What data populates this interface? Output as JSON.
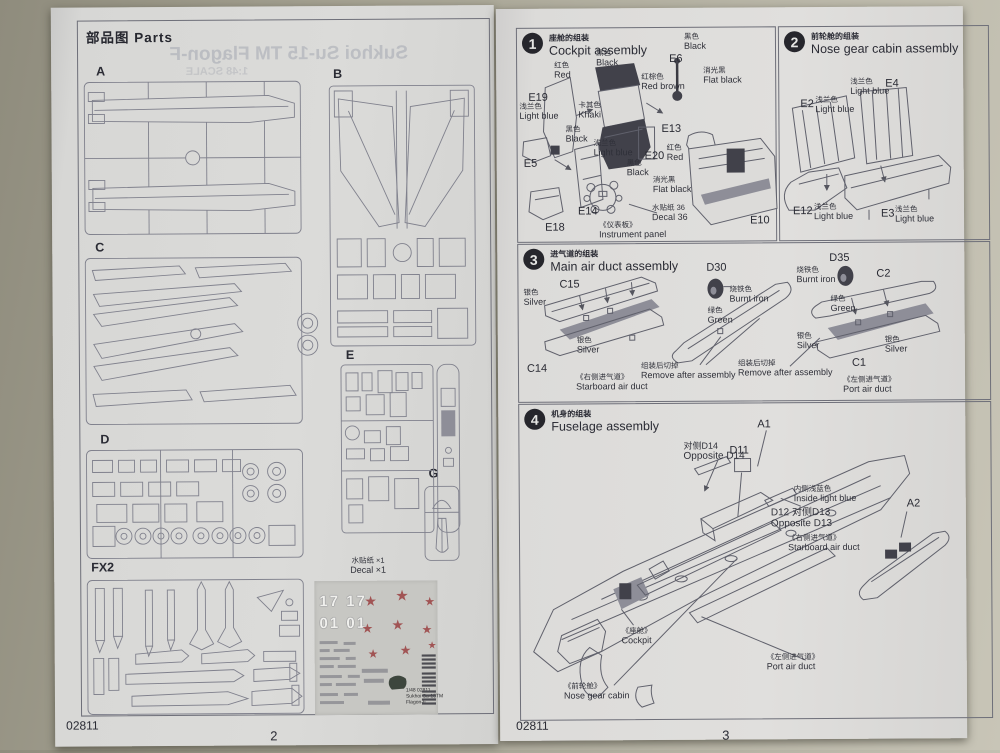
{
  "left_page": {
    "header": "部品图  Parts",
    "ghost_title": "Sukhoi Su-15 TM Flagon-F",
    "ghost_scale": "1:48 SCALE",
    "sprues": {
      "a": "A",
      "b": "B",
      "c": "C",
      "d": "D",
      "e": "E",
      "g": "G",
      "fx2": "FX2"
    },
    "decal": {
      "cn": "水贴纸 ×1",
      "en": "Decal ×1",
      "n17": "17 17",
      "n01": "01 01",
      "foot1": "1/48 02811",
      "foot2": "Sukhoi Su-15TM",
      "foot3": "Flagon-F"
    },
    "code": "02811",
    "page": "2"
  },
  "right_page": {
    "code": "02811",
    "page": "3",
    "s1": {
      "num": "1",
      "cn": "座舱的组装",
      "en": "Cockpit assembly"
    },
    "s2": {
      "num": "2",
      "cn": "前轮舱的组装",
      "en": "Nose gear cabin assembly"
    },
    "s3": {
      "num": "3",
      "cn": "进气道的组装",
      "en": "Main air duct assembly"
    },
    "s4": {
      "num": "4",
      "cn": "机身的组装",
      "en": "Fuselage assembly"
    },
    "s1l": {
      "red1": {
        "cn": "红色",
        "en": "Red"
      },
      "black1": {
        "cn": "黑色",
        "en": "Black"
      },
      "e6": "E6",
      "black2": {
        "cn": "黑色",
        "en": "Black"
      },
      "flatblack1": {
        "cn": "消光黑",
        "en": "Flat black"
      },
      "redbrown": {
        "cn": "红棕色",
        "en": "Red brown"
      },
      "e19": "E19",
      "khaki": {
        "cn": "卡其色",
        "en": "Khaki"
      },
      "lightblue1": {
        "cn": "浅兰色",
        "en": "Light blue"
      },
      "black3": {
        "cn": "黑色",
        "en": "Black"
      },
      "e13": "E13",
      "lightblue2": {
        "cn": "浅兰色",
        "en": "Light blue"
      },
      "e20": "E20",
      "red2": {
        "cn": "红色",
        "en": "Red"
      },
      "e5": "E5",
      "black4": {
        "cn": "黑色",
        "en": "Black"
      },
      "flatblack2": {
        "cn": "消光黑",
        "en": "Flat black"
      },
      "e14": "E14",
      "e18": "E18",
      "decal36": {
        "cn": "水贴纸 36",
        "en": "Decal 36"
      },
      "panel": {
        "cn": "《仪表板》",
        "en": "Instrument panel"
      },
      "e10": "E10"
    },
    "s2l": {
      "e2": "E2",
      "e4": "E4",
      "e12": "E12",
      "e3": "E3",
      "lb1": {
        "cn": "浅兰色",
        "en": "Light blue"
      },
      "lb2": {
        "cn": "浅兰色",
        "en": "Light blue"
      },
      "lb3": {
        "cn": "浅兰色",
        "en": "Light blue"
      },
      "lb4": {
        "cn": "浅兰色",
        "en": "Light blue"
      }
    },
    "s3l": {
      "c15": "C15",
      "c14": "C14",
      "c2": "C2",
      "c1": "C1",
      "d30": "D30",
      "d35": "D35",
      "silver1": {
        "cn": "银色",
        "en": "Silver"
      },
      "silver2": {
        "cn": "银色",
        "en": "Silver"
      },
      "silver3": {
        "cn": "银色",
        "en": "Silver"
      },
      "silver4": {
        "cn": "银色",
        "en": "Silver"
      },
      "burnt1": {
        "cn": "烧铁色",
        "en": "Burnt iron"
      },
      "burnt2": {
        "cn": "烧铁色",
        "en": "Burnt iron"
      },
      "green1": {
        "cn": "绿色",
        "en": "Green"
      },
      "green2": {
        "cn": "绿色",
        "en": "Green"
      },
      "remove1": {
        "cn": "组装后切掉",
        "en": "Remove after assembly"
      },
      "remove2": {
        "cn": "组装后切掉",
        "en": "Remove after assembly"
      },
      "starboard": {
        "cn": "《右侧进气道》",
        "en": "Starboard air duct"
      },
      "port": {
        "cn": "《左侧进气道》",
        "en": "Port air duct"
      }
    },
    "s4l": {
      "a1": "A1",
      "a2": "A2",
      "d11": "D11",
      "d14": {
        "cn": "对侧D14",
        "en": "Opposite D14"
      },
      "d13": {
        "cn": "D12 对侧D13",
        "en": "Opposite D13"
      },
      "inside": {
        "cn": "内侧浅蓝色",
        "en": "Inside light blue"
      },
      "starboard": {
        "cn": "《右侧进气道》",
        "en": "Starboard air duct"
      },
      "cockpit": {
        "cn": "《座舱》",
        "en": "Cockpit"
      },
      "port": {
        "cn": "《左侧进气道》",
        "en": "Port air duct"
      },
      "nose": {
        "cn": "《前轮舱》",
        "en": "Nose gear cabin"
      }
    }
  }
}
